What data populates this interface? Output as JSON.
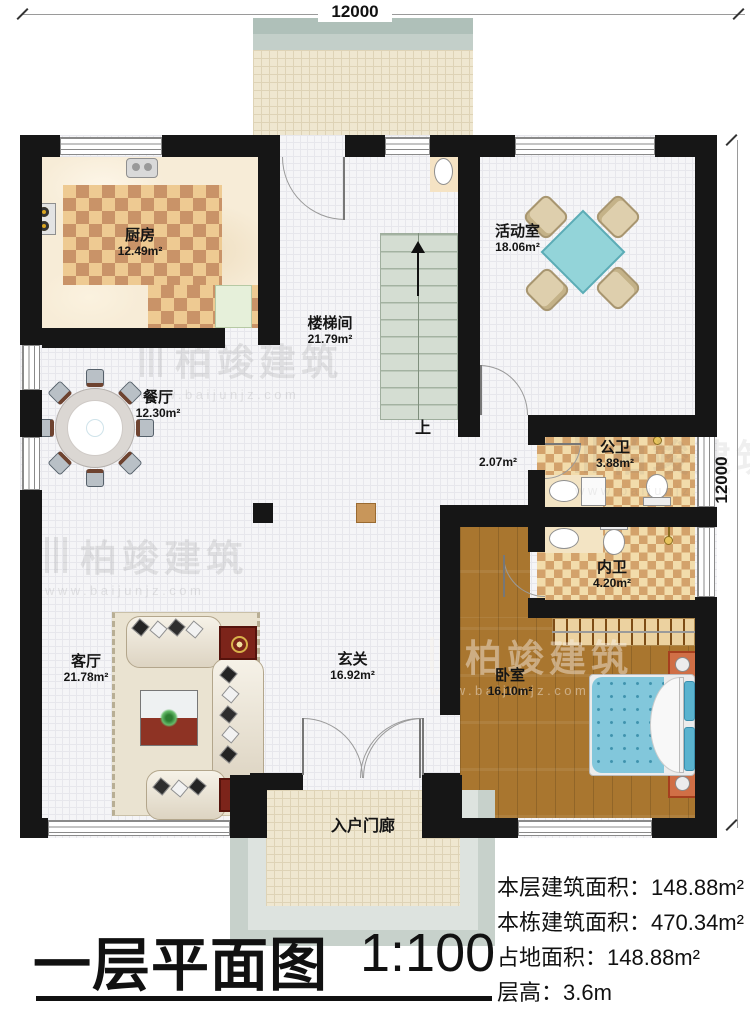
{
  "plan": {
    "dimensions": {
      "top": "12000",
      "right": "12000"
    },
    "stair_up_label": "上",
    "rooms": {
      "kitchen": {
        "name": "厨房",
        "area": "12.49m²"
      },
      "stairwell": {
        "name": "楼梯间",
        "area": "21.79m²"
      },
      "activity": {
        "name": "活动室",
        "area": "18.06m²"
      },
      "dining": {
        "name": "餐厅",
        "area": "12.30m²"
      },
      "corridor": {
        "area": "2.07m²"
      },
      "public_bath": {
        "name": "公卫",
        "area": "3.88m²"
      },
      "inner_bath": {
        "name": "内卫",
        "area": "4.20m²"
      },
      "living": {
        "name": "客厅",
        "area": "21.78m²"
      },
      "entry": {
        "name": "玄关",
        "area": "16.92m²"
      },
      "bedroom": {
        "name": "卧室",
        "area": "16.10m²"
      },
      "porch": {
        "name": "入户门廊"
      }
    }
  },
  "watermark": {
    "brand": "柏竣建筑",
    "url": "www.baijunjz.com"
  },
  "footer": {
    "title": "一层平面图",
    "scale": "1:100",
    "stats": [
      {
        "label": "本层建筑面积：",
        "value": "148.88m²"
      },
      {
        "label": "本栋建筑面积：",
        "value": "470.34m²"
      },
      {
        "label": "占地面积：",
        "value": "148.88m²"
      },
      {
        "label": "层高：",
        "value": "3.6m"
      }
    ]
  },
  "colors": {
    "wall": "#161616",
    "stairs": "#d4ddd2",
    "bed": "#82c7db",
    "activity_table": "#92d3d8",
    "wood": "#a9762f"
  }
}
